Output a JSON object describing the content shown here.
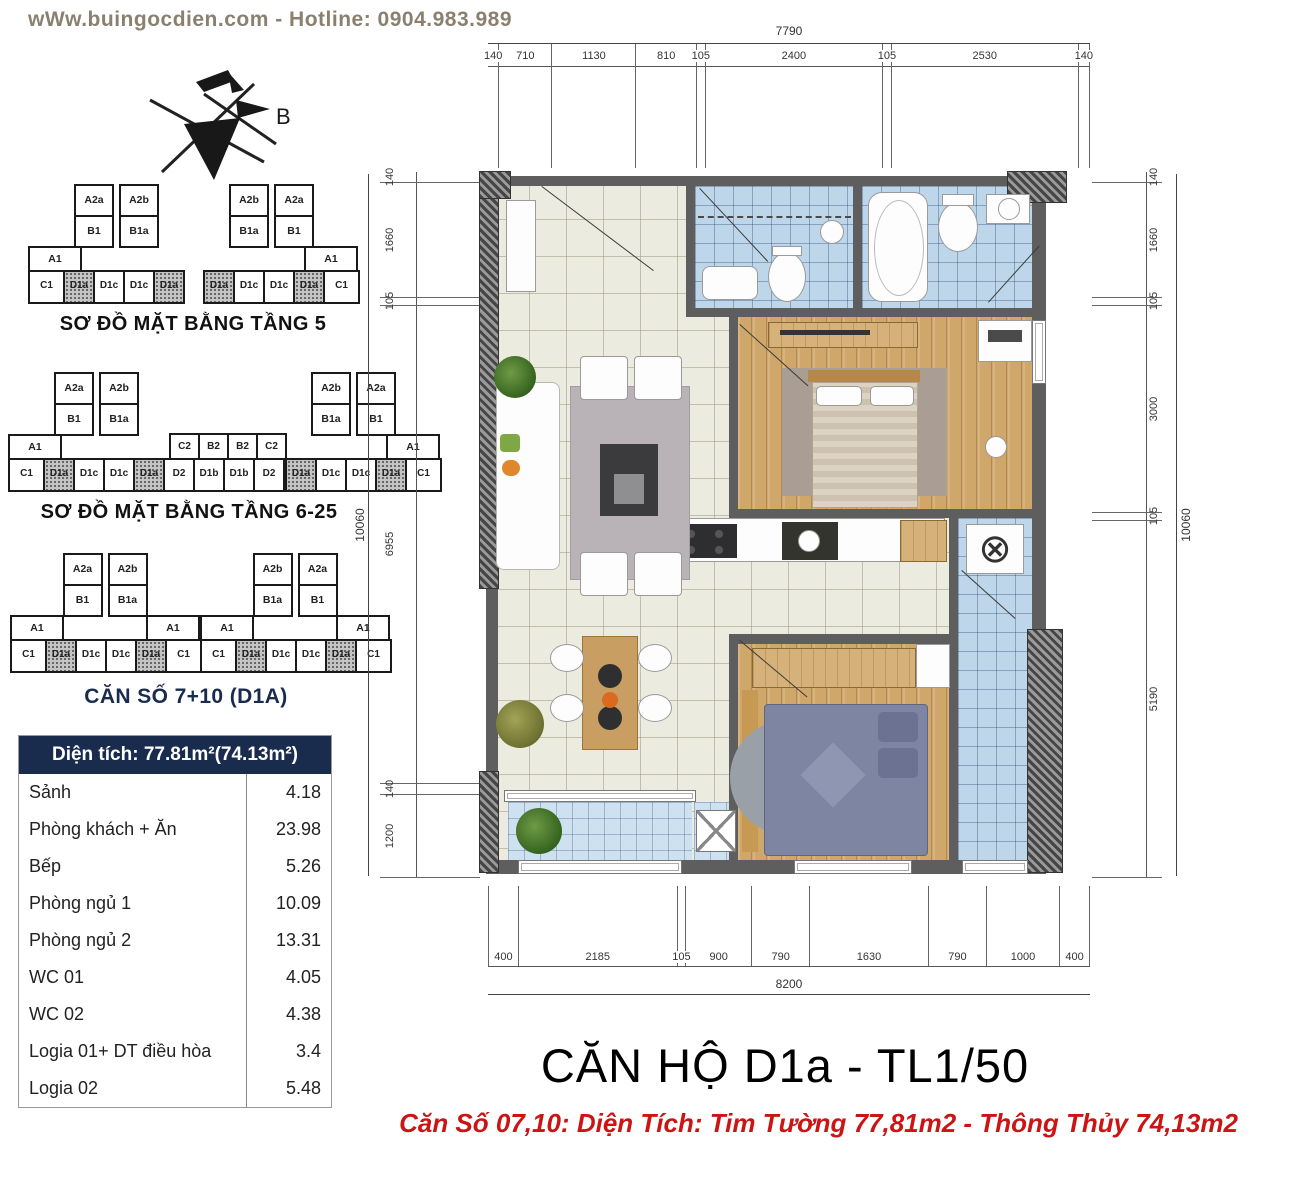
{
  "watermark": "wWw.buingocdien.com  -  Hotline: 0904.983.989",
  "compass": {
    "label": "B"
  },
  "floor_diagrams": [
    {
      "title": "SƠ ĐỒ MẶT BẰNG TẦNG 5",
      "clusters": [
        {
          "type": "side",
          "towers": [
            [
              "A2a",
              "B1"
            ],
            [
              "A2b",
              "B1a"
            ]
          ],
          "a1_side": "left",
          "a1_labels": [
            "A1"
          ],
          "row": [
            {
              "l": "C1"
            },
            {
              "l": "D1a",
              "h": 1
            },
            {
              "l": "D1c"
            },
            {
              "l": "D1c"
            },
            {
              "l": "D1a",
              "h": 1
            }
          ]
        },
        {
          "type": "side",
          "towers": [
            [
              "A2b",
              "B1a"
            ],
            [
              "A2a",
              "B1"
            ]
          ],
          "a1_side": "right",
          "a1_labels": [
            "A1"
          ],
          "row": [
            {
              "l": "D1a",
              "h": 1
            },
            {
              "l": "D1c"
            },
            {
              "l": "D1c"
            },
            {
              "l": "D1a",
              "h": 1
            },
            {
              "l": "C1"
            }
          ]
        }
      ]
    },
    {
      "title": "SƠ ĐỒ MẶT BẰNG TẦNG 6-25",
      "clusters": [
        {
          "type": "side",
          "towers": [
            [
              "A2a",
              "B1"
            ],
            [
              "A2b",
              "B1a"
            ]
          ],
          "a1_side": "left",
          "a1_labels": [
            "A1"
          ],
          "row": [
            {
              "l": "C1"
            },
            {
              "l": "D1a",
              "h": 1
            },
            {
              "l": "D1c"
            },
            {
              "l": "D1c"
            },
            {
              "l": "D1a",
              "h": 1
            }
          ]
        },
        {
          "type": "mid",
          "top": [
            "C2",
            "B2",
            "B2",
            "C2"
          ],
          "row": [
            {
              "l": "D2"
            },
            {
              "l": "D1b"
            },
            {
              "l": "D1b"
            },
            {
              "l": "D2"
            }
          ]
        },
        {
          "type": "side",
          "towers": [
            [
              "A2b",
              "B1a"
            ],
            [
              "A2a",
              "B1"
            ]
          ],
          "a1_side": "right",
          "a1_labels": [
            "A1"
          ],
          "row": [
            {
              "l": "D1a",
              "h": 1
            },
            {
              "l": "D1c"
            },
            {
              "l": "D1c"
            },
            {
              "l": "D1a",
              "h": 1
            },
            {
              "l": "C1"
            }
          ]
        }
      ]
    },
    {
      "title": "CĂN SỐ 7+10 (D1A)",
      "clusters": [
        {
          "type": "side",
          "towers": [
            [
              "A2a",
              "B1"
            ],
            [
              "A2b",
              "B1a"
            ]
          ],
          "a1_side": "both",
          "a1_labels": [
            "A1",
            "A1"
          ],
          "row": [
            {
              "l": "C1"
            },
            {
              "l": "D1a",
              "h": 1
            },
            {
              "l": "D1c"
            },
            {
              "l": "D1c"
            },
            {
              "l": "D1a",
              "h": 1
            },
            {
              "l": "C1"
            }
          ]
        },
        {
          "type": "side",
          "towers": [
            [
              "A2b",
              "B1a"
            ],
            [
              "A2a",
              "B1"
            ]
          ],
          "a1_side": "both",
          "a1_labels": [
            "A1",
            "A1"
          ],
          "row": [
            {
              "l": "C1"
            },
            {
              "l": "D1a",
              "h": 1
            },
            {
              "l": "D1c"
            },
            {
              "l": "D1c"
            },
            {
              "l": "D1a",
              "h": 1
            },
            {
              "l": "C1"
            }
          ]
        }
      ]
    }
  ],
  "area_table": {
    "header": "Diện tích: 77.81m²(74.13m²)",
    "rows": [
      {
        "name": "Sảnh",
        "value": "4.18"
      },
      {
        "name": "Phòng khách + Ăn",
        "value": "23.98"
      },
      {
        "name": "Bếp",
        "value": "5.26"
      },
      {
        "name": "Phòng ngủ 1",
        "value": "10.09"
      },
      {
        "name": "Phòng ngủ 2",
        "value": "13.31"
      },
      {
        "name": "WC 01",
        "value": "4.05"
      },
      {
        "name": "WC 02",
        "value": "4.38"
      },
      {
        "name": "Logia 01+ DT điều hòa",
        "value": "3.4"
      },
      {
        "name": "Logia 02",
        "value": "5.48"
      }
    ]
  },
  "dims": {
    "top": {
      "total": "7790",
      "segments": [
        140,
        710,
        1130,
        810,
        105,
        2400,
        105,
        2530,
        140
      ]
    },
    "bottom": {
      "total": "8200",
      "segments": [
        400,
        2185,
        105,
        900,
        790,
        1630,
        790,
        1000,
        400
      ]
    },
    "left": {
      "total": "10060",
      "segments": [
        140,
        1660,
        105,
        6955,
        140,
        1200
      ]
    },
    "right": {
      "total": "10060",
      "segments": [
        140,
        1660,
        105,
        3000,
        105,
        5190
      ]
    }
  },
  "title": "CĂN HỘ D1a - TL1/50",
  "subtitle": "Căn Số 07,10: Diện Tích: Tim Tường 77,81m2 - Thông Thủy 74,13m2",
  "colors": {
    "navy": "#1a2c4e",
    "red": "#cc1414",
    "watermark": "#8b8070"
  }
}
